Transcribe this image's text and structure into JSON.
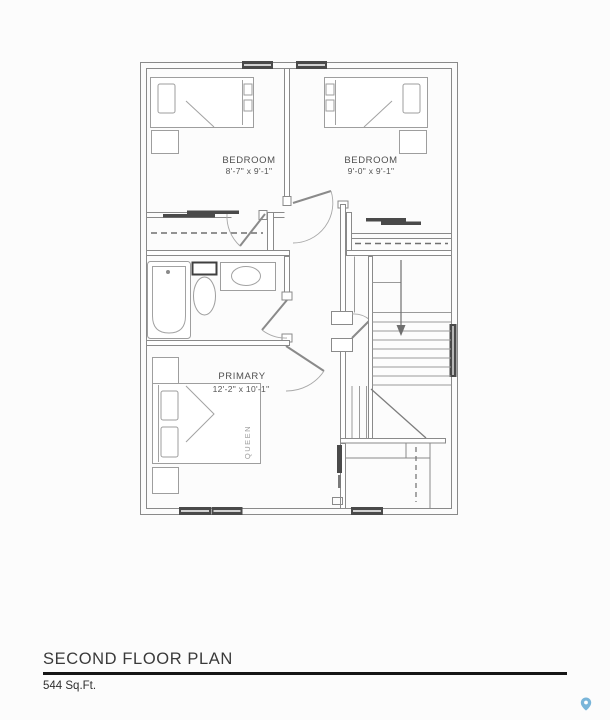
{
  "title_block": {
    "title": "SECOND FLOOR PLAN",
    "area": "544 Sq.Ft."
  },
  "plan": {
    "rooms": [
      {
        "label": "BEDROOM",
        "dimensions": "8'-7\" x 9'-1\""
      },
      {
        "label": "BEDROOM",
        "dimensions": "9'-0\" x 9'-1\""
      },
      {
        "label": "PRIMARY",
        "dimensions": "12'-2\" x 10'-1\""
      }
    ],
    "bed_label": "QUEEN"
  },
  "colors": {
    "wall_line": "#8a8a8a",
    "dark_fixture": "#4a4a4a",
    "label_text": "#4f4f4f",
    "map_pin": "#79b5d9"
  }
}
